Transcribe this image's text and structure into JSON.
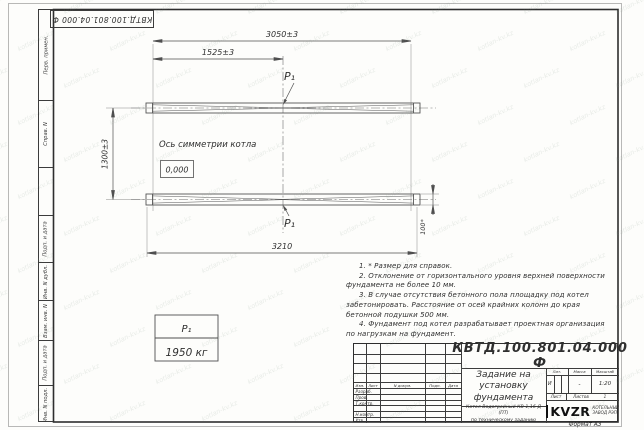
{
  "doc_number": "КВТД.100.801.04.000  Ф",
  "margin": {
    "cells": [
      {
        "label": "Перв. примен."
      },
      {
        "label": "Справ. N"
      },
      {
        "label": ""
      },
      {
        "label": "Подп. и дата"
      },
      {
        "label": "Инв. N дубл."
      },
      {
        "label": "Взам. инв. N"
      },
      {
        "label": "Подп. и дата"
      },
      {
        "label": "Инв. N подл."
      }
    ]
  },
  "drawing": {
    "dim_3050": "3050±3",
    "dim_1525": "1525±3",
    "dim_1300": "1300±3",
    "dim_3210": "3210",
    "dim_100": "100*",
    "axis_label": "Ось симметрии котла",
    "elevation": "0,000",
    "load_label": "P₁"
  },
  "load_table": {
    "name": "P₁",
    "value": "1950 кг"
  },
  "notes": [
    "1. * Размер для справок.",
    "2. Отклонение от горизонтального уровня верхней поверхности фундамента не более 10 мм.",
    "3. В случае отсутствия бетонного пола площадку под котел забетонировать. Расстояние от осей крайних колонн до края бетонной подушки 500 мм.",
    "4. Фундамент под котел разрабатывает проектная организация по нагрузкам на фундамент."
  ],
  "title_block": {
    "columns": [
      "Изм.",
      "Лист",
      "N докум.",
      "Подп.",
      "Дата"
    ],
    "rows": [
      "Разраб.",
      "Пров.",
      "Т.контр.",
      "",
      "Н.контр.",
      "Утв."
    ],
    "title_lines": [
      "Задание на",
      "установку",
      "фундамента"
    ],
    "subtitle_lines": [
      "Котел Водогрейный КВ-1,16 Д (ПТ)",
      "по техническому заданию"
    ],
    "lit_label": "Лит.",
    "mass_label": "Масса",
    "scale_label": "Масштаб",
    "lit_value": "И",
    "mass_value": "-",
    "scale_value": "1:20",
    "sheet_label": "Лист",
    "sheets_label": "Листов",
    "sheets_value": "1",
    "logo_text": "KVZR",
    "logo_caption": [
      "КОТЕЛЬНЫЙ",
      "ЗАВОД РЭП"
    ],
    "format_label": "Формат А3"
  },
  "watermark": {
    "text": "kotlan-kv.kz"
  },
  "colors": {
    "ink": "#2f2f2f",
    "line": "#555555",
    "frame": "#2e2e2e",
    "watermark": "#7f9585"
  }
}
